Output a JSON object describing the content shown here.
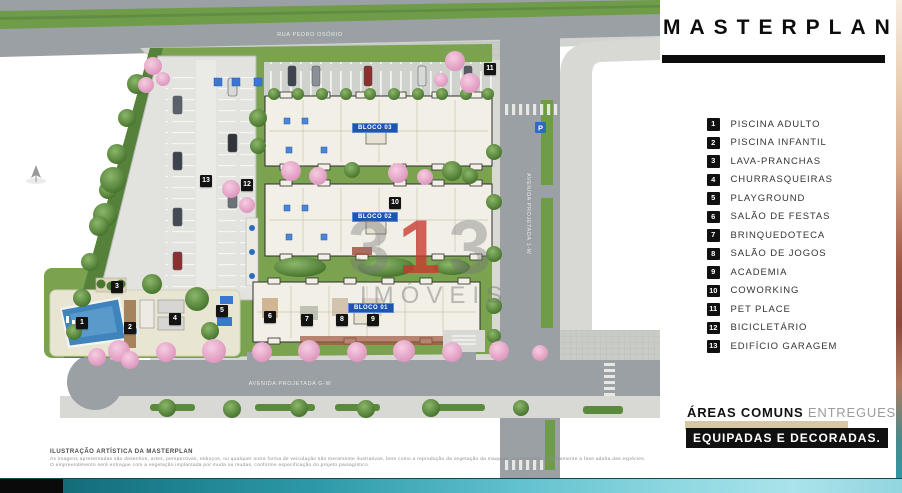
{
  "panel": {
    "title": "MASTERPLAN",
    "legend": [
      {
        "num": "1",
        "label": "PISCINA ADULTO"
      },
      {
        "num": "2",
        "label": "PISCINA INFANTIL"
      },
      {
        "num": "3",
        "label": "LAVA-PRANCHAS"
      },
      {
        "num": "4",
        "label": "CHURRASQUEIRAS"
      },
      {
        "num": "5",
        "label": "PLAYGROUND"
      },
      {
        "num": "6",
        "label": "SALÃO DE FESTAS"
      },
      {
        "num": "7",
        "label": "BRINQUEDOTECA"
      },
      {
        "num": "8",
        "label": "SALÃO DE JOGOS"
      },
      {
        "num": "9",
        "label": "ACADEMIA"
      },
      {
        "num": "10",
        "label": "COWORKING"
      },
      {
        "num": "11",
        "label": "PET PLACE"
      },
      {
        "num": "12",
        "label": "BICICLETÁRIO"
      },
      {
        "num": "13",
        "label": "EDIFÍCIO GARAGEM"
      }
    ],
    "footer": {
      "bold": "ÁREAS COMUNS",
      "light": " ENTREGUES",
      "banner": "EQUIPADAS E DECORADAS."
    }
  },
  "map": {
    "streets": {
      "top": "RUA PEDRO OSÓRIO",
      "right": "AVENIDA PROJETADA 1-W",
      "bottom": "AVENIDA PROJETADA G-W"
    },
    "bloco_labels": [
      {
        "label": "BLOCO 03",
        "x": 375,
        "y": 128
      },
      {
        "label": "BLOCO 02",
        "x": 375,
        "y": 217
      },
      {
        "label": "BLOCO 01",
        "x": 371,
        "y": 308
      }
    ],
    "markers": [
      {
        "num": "1",
        "x": 82,
        "y": 323
      },
      {
        "num": "2",
        "x": 130,
        "y": 328
      },
      {
        "num": "3",
        "x": 117,
        "y": 287
      },
      {
        "num": "4",
        "x": 175,
        "y": 319
      },
      {
        "num": "5",
        "x": 222,
        "y": 311
      },
      {
        "num": "6",
        "x": 270,
        "y": 317
      },
      {
        "num": "7",
        "x": 307,
        "y": 320
      },
      {
        "num": "8",
        "x": 342,
        "y": 320
      },
      {
        "num": "9",
        "x": 373,
        "y": 320
      },
      {
        "num": "10",
        "x": 395,
        "y": 203
      },
      {
        "num": "11",
        "x": 490,
        "y": 69
      },
      {
        "num": "12",
        "x": 247,
        "y": 185
      },
      {
        "num": "13",
        "x": 206,
        "y": 181
      }
    ],
    "watermark": {
      "d1": "3",
      "d2": "1",
      "d3": "3",
      "word": "IMÓVEIS"
    },
    "colors": {
      "street": "#9aa0a3",
      "lawn": "#7aa24f",
      "building": "#f2efe6",
      "pool": "#3f84bd",
      "marker": "#131313",
      "bloco_label": "#1d55b0",
      "accent_tan": "#d9c7a3",
      "strip_teal": "#2d99a8"
    }
  },
  "disclaimer": {
    "title": "ILUSTRAÇÃO ARTÍSTICA DA MASTERPLAN",
    "body": "As imagens apresentadas são desenhos, artes, perspectivas, esboços, ou qualquer outra forma de veiculação são meramente ilustrativas, bem como a reprodução da vegetação da maquete, representam artisticamente a fase adulta das espécies. O empreendimento será entregue com a vegetação implantada por muda ou mudas, conforme especificação do projeto paisagístico."
  }
}
